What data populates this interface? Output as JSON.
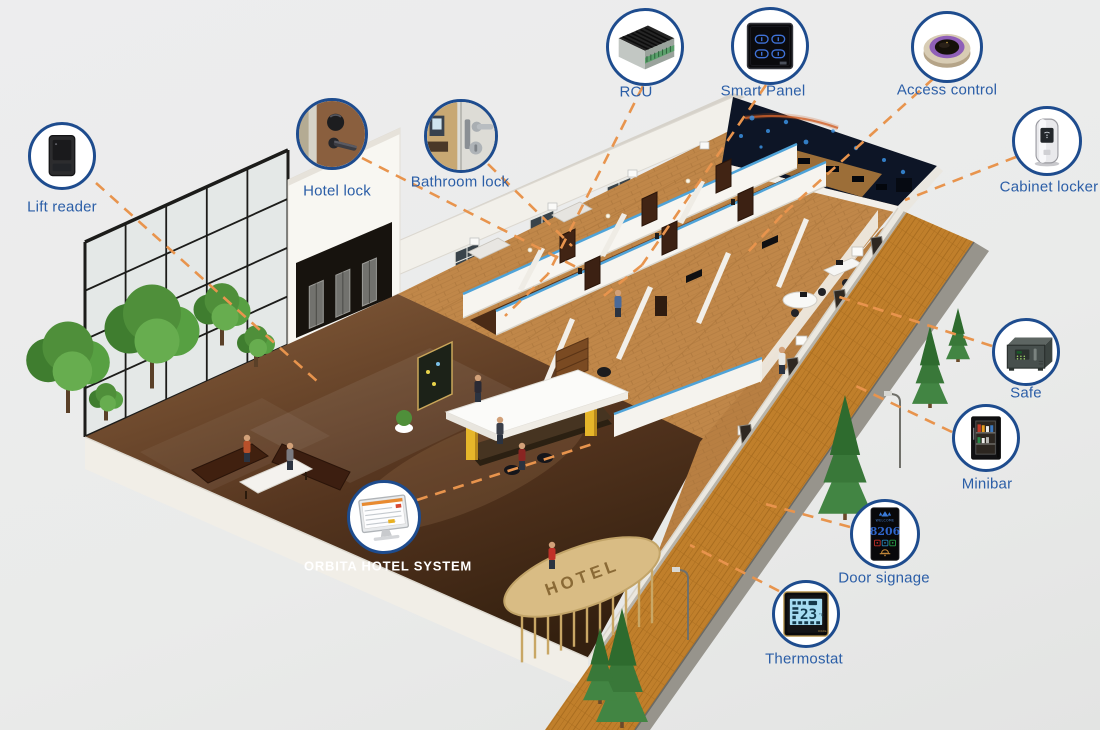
{
  "title": "Orbita smart hotel solution diagram",
  "colors": {
    "background": "#ebeceb",
    "label_blue": "#2b5ea7",
    "circle_border": "#1e4c8e",
    "dash_orange": "#e8944d",
    "wall_blue_trim": "#4fa3d8"
  },
  "building": {
    "entrance_sign": "HOTEL"
  },
  "device_screens": {
    "door_signage": {
      "header": "WELCOME",
      "room_number": "8206"
    },
    "thermostat": {
      "temperature": "23",
      "unit": "°C"
    }
  },
  "callouts": [
    {
      "id": "lift-reader",
      "label": "Lift reader",
      "cx": 62,
      "cy": 156,
      "r": 34,
      "lx": 62,
      "ly": 207,
      "line": [
        96,
        183,
        318,
        382
      ]
    },
    {
      "id": "hotel-lock",
      "label": "Hotel lock",
      "cx": 332,
      "cy": 134,
      "r": 36,
      "lx": 337,
      "ly": 191,
      "line": [
        362,
        158,
        578,
        268
      ]
    },
    {
      "id": "bathroom-lock",
      "label": "Bathroom lock",
      "cx": 461,
      "cy": 136,
      "r": 37,
      "lx": 460,
      "ly": 182,
      "line": [
        488,
        164,
        572,
        246
      ]
    },
    {
      "id": "rcu",
      "label": "RCU",
      "cx": 645,
      "cy": 47,
      "r": 39,
      "lx": 636,
      "ly": 92,
      "line": [
        643,
        86,
        548,
        274
      ]
    },
    {
      "id": "smart-panel",
      "label": "Smart Panel",
      "cx": 770,
      "cy": 46,
      "r": 39,
      "lx": 763,
      "ly": 91,
      "line": [
        766,
        85,
        642,
        265
      ]
    },
    {
      "id": "access-control",
      "label": "Access control",
      "cx": 947,
      "cy": 47,
      "r": 36,
      "lx": 947,
      "ly": 90,
      "line": [
        934,
        78,
        782,
        215
      ]
    },
    {
      "id": "cabinet-locker",
      "label": "Cabinet locker",
      "cx": 1047,
      "cy": 141,
      "r": 35,
      "lx": 1049,
      "ly": 187,
      "line": [
        1016,
        157,
        905,
        200
      ]
    },
    {
      "id": "safe",
      "label": "Safe",
      "cx": 1026,
      "cy": 352,
      "r": 34,
      "lx": 1026,
      "ly": 393,
      "line": [
        992,
        346,
        868,
        306
      ]
    },
    {
      "id": "minibar",
      "label": "Minibar",
      "cx": 986,
      "cy": 438,
      "r": 34,
      "lx": 987,
      "ly": 484,
      "line": [
        952,
        432,
        856,
        386
      ]
    },
    {
      "id": "door-signage",
      "label": "Door signage",
      "cx": 885,
      "cy": 534,
      "r": 35,
      "lx": 884,
      "ly": 578,
      "line": [
        850,
        527,
        758,
        502
      ]
    },
    {
      "id": "thermostat",
      "label": "Thermostat",
      "cx": 806,
      "cy": 614,
      "r": 34,
      "lx": 804,
      "ly": 659,
      "line": [
        779,
        591,
        690,
        545
      ]
    },
    {
      "id": "orbita-hotel-system",
      "label": "ORBITA HOTEL SYSTEM",
      "cx": 384,
      "cy": 517,
      "r": 37,
      "lx": 388,
      "ly": 566,
      "label_color": "#ffffff",
      "line": [
        417,
        500,
        596,
        443
      ]
    }
  ],
  "extra_segments": [
    [
      548,
      274,
      505,
      316
    ],
    [
      642,
      265,
      600,
      299
    ],
    [
      868,
      306,
      836,
      296
    ],
    [
      782,
      215,
      748,
      252
    ]
  ]
}
